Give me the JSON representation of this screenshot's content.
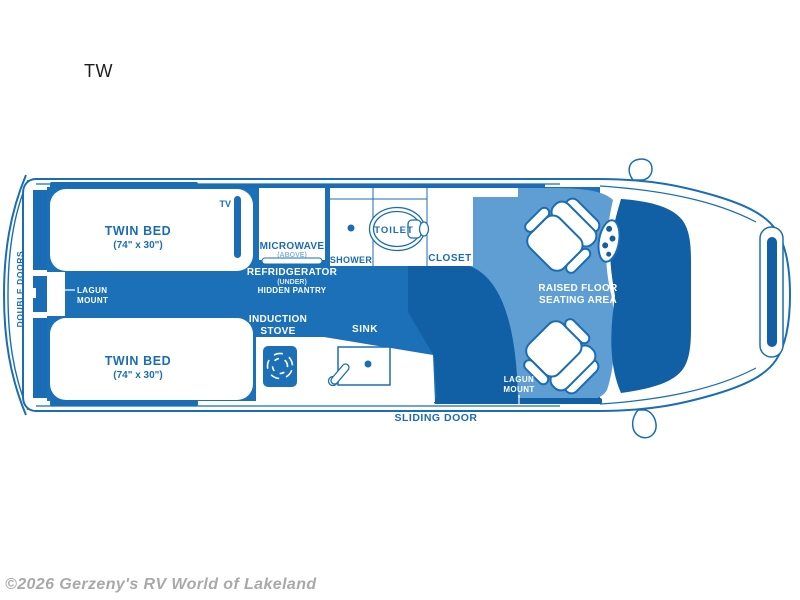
{
  "page": {
    "title": "TW",
    "watermark": "©2026 Gerzeny's RV World of Lakeland"
  },
  "colors": {
    "outline_blue": "#1a6db4",
    "floor_main": "#1b70b7",
    "floor_dark": "#115fa4",
    "floor_raised_light": "#5f9ed2",
    "label_on_white": "#1a6db4",
    "label_on_blue": "#ffffff",
    "watermark_gray": "#a9a9a9"
  },
  "floorplan": {
    "rear": {
      "double_doors": "DOUBLE DOORS"
    },
    "bed_top": {
      "name": "TWIN BED",
      "size": "(74\" x 30\")"
    },
    "bed_bottom": {
      "name": "TWIN BED",
      "size": "(74\" x 30\")"
    },
    "tv": "TV",
    "lagun_left": {
      "line1": "LAGUN",
      "line2": "MOUNT"
    },
    "galley": {
      "microwave": "MICROWAVE",
      "microwave_sub": "(ABOVE)",
      "refrigerator": "REFRIDGERATOR",
      "refrigerator_sub": "(UNDER)",
      "pantry": "HIDDEN PANTRY"
    },
    "bath": {
      "shower": "SHOWER",
      "toilet": "TOILET",
      "closet": "CLOSET"
    },
    "kitchen": {
      "stove_line1": "INDUCTION",
      "stove_line2": "STOVE",
      "sink": "SINK"
    },
    "seating": {
      "line1": "RAISED FLOOR",
      "line2": "SEATING AREA"
    },
    "lagun_right": {
      "line1": "LAGUN",
      "line2": "MOUNT"
    },
    "sliding_door": "SLIDING DOOR"
  }
}
